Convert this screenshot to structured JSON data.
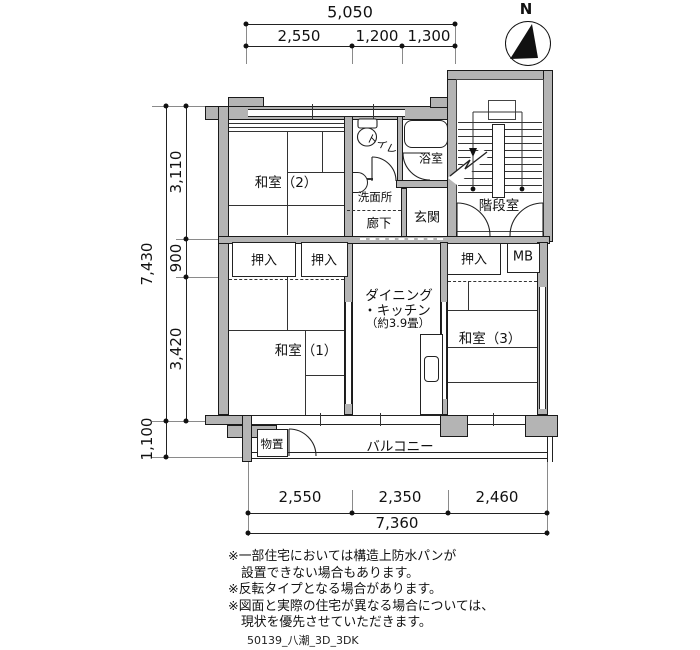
{
  "compass": {
    "label": "N"
  },
  "dimensions": {
    "top": {
      "total": "5,050",
      "segments": [
        "2,550",
        "1,200",
        "1,300"
      ]
    },
    "left": {
      "total": "7,430",
      "segments": [
        "3,110",
        "900",
        "3,420"
      ],
      "balcony_depth": "1,100"
    },
    "bottom": {
      "total": "7,360",
      "segments": [
        "2,550",
        "2,350",
        "2,460"
      ]
    }
  },
  "rooms": {
    "washitsu2": "和室（2）",
    "toilet": "トイレ",
    "bath": "浴室",
    "washroom": "洗面所",
    "hallway": "廊下",
    "entrance": "玄関",
    "stairwell": "階段室",
    "closet_a": "押入",
    "closet_b": "押入",
    "closet_c": "押入",
    "meter_box": "MB",
    "dk_line1": "ダイニング",
    "dk_line2": "・キッチン",
    "dk_line3": "（約3.9畳）",
    "washitsu1": "和室（1）",
    "washitsu3": "和室（3）",
    "storage": "物置",
    "balcony": "バルコニー"
  },
  "notes": [
    "※一部住宅においては構造上防水パンが",
    "設置できない場合もあります。",
    "※反転タイプとなる場合があります。",
    "※図面と実際の住宅が異なる場合については、",
    "現状を優先させていただきます。"
  ],
  "footer": {
    "drawing_id": "50139_八潮_3D_3DK"
  }
}
